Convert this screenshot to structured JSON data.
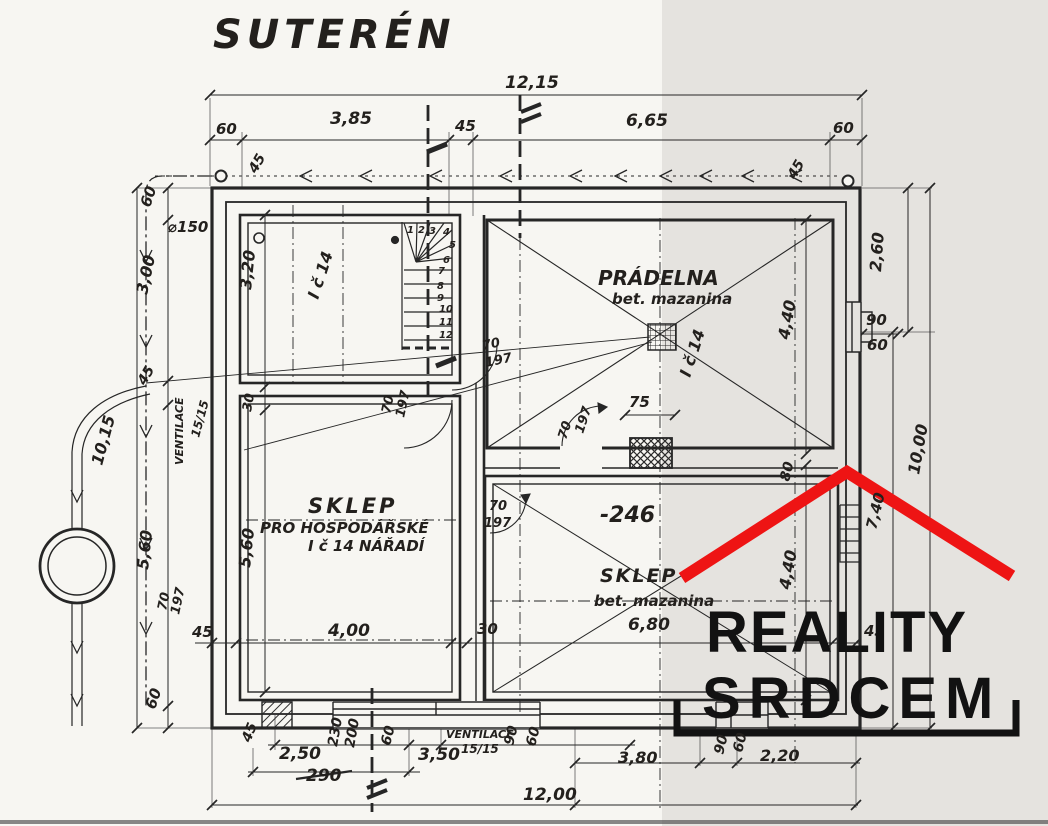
{
  "colors": {
    "paper": "#f7f6f2",
    "band": "#e5e3df",
    "ink": "#262626",
    "watermark_roof": "#ee1414",
    "watermark_text": "#121212"
  },
  "plan": {
    "level_name": "SUTERÉN",
    "rooms": [
      {
        "name": "PRÁDELNA",
        "floor": "bet. mazanina",
        "unit": "I č 14"
      },
      {
        "name": "SKLEP PRO HOSPODÁŘSKÉ NÁŘADÍ",
        "unit": "I č 14"
      },
      {
        "name": "SKLEP",
        "floor": "bet. mazanina",
        "level_mark": "-246"
      }
    ]
  },
  "watermark": {
    "line1": "REALITY",
    "line2": "SRDCEM"
  },
  "labels": {
    "title": [
      {
        "t": "SUTERÉN",
        "x": 213,
        "y": 48,
        "s": 40,
        "c": "ttl",
        "n": "plan-title"
      }
    ],
    "dims_top": [
      {
        "t": "12,15",
        "x": 505,
        "y": 88,
        "s": 17,
        "n": "dim-overall-width"
      },
      {
        "t": "60",
        "x": 216,
        "y": 134,
        "s": 15
      },
      {
        "t": "3,85",
        "x": 330,
        "y": 124,
        "s": 17
      },
      {
        "t": "45",
        "x": 455,
        "y": 131,
        "s": 15
      },
      {
        "t": "6,65",
        "x": 626,
        "y": 126,
        "s": 17
      },
      {
        "t": "60",
        "x": 833,
        "y": 133,
        "s": 15
      },
      {
        "t": "45",
        "x": 256,
        "y": 174,
        "s": 14,
        "r": -60
      },
      {
        "t": "45",
        "x": 795,
        "y": 180,
        "s": 14,
        "r": -60
      }
    ],
    "dims_left": [
      {
        "t": "60",
        "x": 150,
        "y": 208,
        "s": 15,
        "r": -72
      },
      {
        "t": "⌀150",
        "x": 168,
        "y": 232,
        "s": 15
      },
      {
        "t": "3,00",
        "x": 147,
        "y": 295,
        "s": 16,
        "r": -78
      },
      {
        "t": "45",
        "x": 145,
        "y": 386,
        "s": 14,
        "r": -60
      },
      {
        "t": "10,15",
        "x": 102,
        "y": 466,
        "s": 16,
        "r": -75
      },
      {
        "t": "VENTILACE",
        "x": 183,
        "y": 465,
        "s": 11,
        "r": -90
      },
      {
        "t": "15/15",
        "x": 199,
        "y": 438,
        "s": 12,
        "r": -75
      },
      {
        "t": "5,60",
        "x": 148,
        "y": 570,
        "s": 16,
        "r": -84
      },
      {
        "t": "60",
        "x": 155,
        "y": 710,
        "s": 15,
        "r": -72
      },
      {
        "t": "45",
        "x": 250,
        "y": 743,
        "s": 14,
        "r": -68
      }
    ],
    "dims_bottom": [
      {
        "t": "45",
        "x": 192,
        "y": 637,
        "s": 15
      },
      {
        "t": "4,00",
        "x": 328,
        "y": 636,
        "s": 17
      },
      {
        "t": "30",
        "x": 477,
        "y": 634,
        "s": 15
      },
      {
        "t": "6,80",
        "x": 628,
        "y": 630,
        "s": 17
      },
      {
        "t": "45",
        "x": 864,
        "y": 636,
        "s": 15
      },
      {
        "t": "2,50",
        "x": 279,
        "y": 759,
        "s": 17
      },
      {
        "t": "230",
        "x": 337,
        "y": 747,
        "s": 14,
        "r": -80
      },
      {
        "t": "200",
        "x": 354,
        "y": 748,
        "s": 14,
        "r": -80
      },
      {
        "t": "60",
        "x": 390,
        "y": 746,
        "s": 14,
        "r": -76
      },
      {
        "t": "3,50",
        "x": 418,
        "y": 760,
        "s": 17
      },
      {
        "t": "VENTILACE",
        "x": 446,
        "y": 738,
        "s": 11
      },
      {
        "t": "15/15",
        "x": 461,
        "y": 753,
        "s": 12
      },
      {
        "t": "90",
        "x": 513,
        "y": 746,
        "s": 14,
        "r": -76
      },
      {
        "t": "60",
        "x": 535,
        "y": 747,
        "s": 14,
        "r": -76
      },
      {
        "t": "290",
        "x": 306,
        "y": 781,
        "s": 17,
        "n": "dim-struck-value"
      },
      {
        "t": "12,00",
        "x": 523,
        "y": 800,
        "s": 17
      },
      {
        "t": "3,80",
        "x": 618,
        "y": 763,
        "s": 16
      },
      {
        "t": "90",
        "x": 723,
        "y": 755,
        "s": 14,
        "r": -76
      },
      {
        "t": "60",
        "x": 742,
        "y": 753,
        "s": 14,
        "r": -76
      },
      {
        "t": "2,20",
        "x": 760,
        "y": 761,
        "s": 16
      }
    ],
    "dims_right": [
      {
        "t": "2,60",
        "x": 881,
        "y": 272,
        "s": 16,
        "r": -86
      },
      {
        "t": "90",
        "x": 866,
        "y": 325,
        "s": 15
      },
      {
        "t": "60",
        "x": 867,
        "y": 350,
        "s": 15
      },
      {
        "t": "10,00",
        "x": 919,
        "y": 475,
        "s": 16,
        "r": -80
      },
      {
        "t": "7,40",
        "x": 876,
        "y": 530,
        "s": 15,
        "r": -76
      }
    ],
    "rooms": [
      {
        "t": "I č 14",
        "x": 318,
        "y": 300,
        "s": 16,
        "r": -72,
        "n": "room-unit-label"
      },
      {
        "t": "3,20",
        "x": 251,
        "y": 290,
        "s": 16,
        "r": -84
      },
      {
        "t": "30",
        "x": 251,
        "y": 412,
        "s": 13,
        "r": -80
      },
      {
        "t": "5,60",
        "x": 250,
        "y": 568,
        "s": 16,
        "r": -84
      },
      {
        "t": "SKLEP",
        "x": 308,
        "y": 513,
        "s": 21,
        "c": "b",
        "ls": 3,
        "n": "room-name-sklep-left"
      },
      {
        "t": "PRO HOSPODÁŘSKÉ",
        "x": 260,
        "y": 533,
        "s": 15
      },
      {
        "t": "I č 14  NÁŘADÍ",
        "x": 308,
        "y": 551,
        "s": 15
      },
      {
        "t": "PRÁDELNA",
        "x": 598,
        "y": 285,
        "s": 20,
        "c": "b",
        "n": "room-name-pradelna"
      },
      {
        "t": "bet. mazanina",
        "x": 612,
        "y": 304,
        "s": 15
      },
      {
        "t": "I č 14",
        "x": 690,
        "y": 378,
        "s": 16,
        "r": -72
      },
      {
        "t": "75",
        "x": 629,
        "y": 407,
        "s": 15
      },
      {
        "t": "4,40",
        "x": 789,
        "y": 340,
        "s": 16,
        "r": -80
      },
      {
        "t": "80",
        "x": 789,
        "y": 482,
        "s": 14,
        "r": -76
      },
      {
        "t": "4,40",
        "x": 790,
        "y": 590,
        "s": 16,
        "r": -80
      },
      {
        "t": "-246",
        "x": 600,
        "y": 522,
        "s": 22,
        "n": "level-mark"
      },
      {
        "t": "SKLEP",
        "x": 600,
        "y": 582,
        "s": 19,
        "c": "b",
        "ls": 2,
        "n": "room-name-sklep-right"
      },
      {
        "t": "bet. mazanina",
        "x": 594,
        "y": 606,
        "s": 15
      }
    ],
    "doors": [
      {
        "t": "70",
        "x": 483,
        "y": 350,
        "s": 13,
        "r": -12
      },
      {
        "t": "197",
        "x": 486,
        "y": 367,
        "s": 13,
        "r": -12
      },
      {
        "t": "70",
        "x": 390,
        "y": 414,
        "s": 13,
        "r": -78
      },
      {
        "t": "197",
        "x": 404,
        "y": 418,
        "s": 13,
        "r": -78
      },
      {
        "t": "70",
        "x": 566,
        "y": 440,
        "s": 13,
        "r": -72
      },
      {
        "t": "197",
        "x": 583,
        "y": 434,
        "s": 13,
        "r": -72
      },
      {
        "t": "70",
        "x": 489,
        "y": 510,
        "s": 13
      },
      {
        "t": "197",
        "x": 484,
        "y": 527,
        "s": 13
      },
      {
        "t": "70",
        "x": 166,
        "y": 611,
        "s": 13,
        "r": -78
      },
      {
        "t": "197",
        "x": 179,
        "y": 615,
        "s": 13,
        "r": -78
      }
    ],
    "stairs": [
      {
        "t": "1",
        "x": 407,
        "y": 233,
        "s": 10
      },
      {
        "t": "2",
        "x": 418,
        "y": 233,
        "s": 10
      },
      {
        "t": "3",
        "x": 429,
        "y": 234,
        "s": 10
      },
      {
        "t": "4",
        "x": 443,
        "y": 235,
        "s": 10
      },
      {
        "t": "5",
        "x": 449,
        "y": 248,
        "s": 10
      },
      {
        "t": "6",
        "x": 443,
        "y": 263,
        "s": 10
      },
      {
        "t": "7",
        "x": 438,
        "y": 274,
        "s": 10
      },
      {
        "t": "8",
        "x": 437,
        "y": 289,
        "s": 10
      },
      {
        "t": "9",
        "x": 437,
        "y": 301,
        "s": 10
      },
      {
        "t": "10",
        "x": 439,
        "y": 312,
        "s": 10
      },
      {
        "t": "11",
        "x": 439,
        "y": 325,
        "s": 10
      },
      {
        "t": "12",
        "x": 439,
        "y": 338,
        "s": 10
      }
    ],
    "watermark": [
      {
        "t": "REALITY",
        "x": 706,
        "y": 652,
        "s": 58,
        "c": "w",
        "ls": 2,
        "n": "watermark-line1"
      },
      {
        "t": "SRDCEM",
        "x": 702,
        "y": 718,
        "s": 58,
        "c": "w",
        "ls": 8,
        "n": "watermark-line2"
      }
    ]
  }
}
